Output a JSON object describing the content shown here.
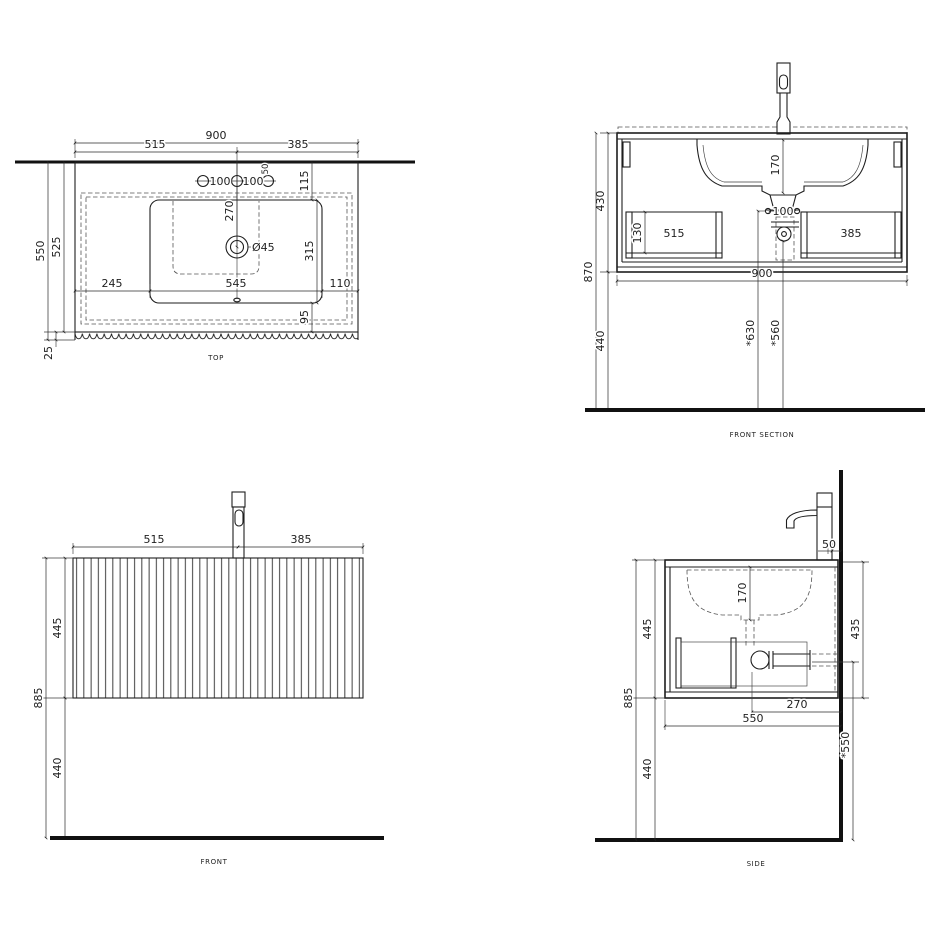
{
  "colors": {
    "ink": "#1e1e1e",
    "background": "#ffffff"
  },
  "views": {
    "top": {
      "title": "TOP",
      "dims": {
        "total_width": "900",
        "left_span": "515",
        "right_span": "385",
        "hole_gap_a": "100",
        "hole_gap_b": "100",
        "side_hole_dia": "50",
        "back_offset": "115",
        "wall_to_drain": "270",
        "cutout_depth": "315",
        "cutout_to_front": "95",
        "depth_total": "550",
        "depth_body": "525",
        "front_edge": "25",
        "left_margin": "245",
        "cutout_width": "545",
        "right_margin": "110",
        "drain_dia": "Ø45"
      }
    },
    "front_section": {
      "title": "FRONT SECTION",
      "dims": {
        "cabinet_height": "430",
        "total_height": "870",
        "floor_clearance": "440",
        "drawer_inner_height": "130",
        "left_drawer": "515",
        "right_drawer": "385",
        "basin_depth": "170",
        "screw_gap": "100",
        "total_width": "900",
        "outlet_height_a": "*630",
        "outlet_height_b": "*560"
      }
    },
    "front": {
      "title": "FRONT",
      "dims": {
        "left_span": "515",
        "right_span": "385",
        "cabinet_height": "445",
        "mount_height": "885",
        "floor_clearance": "440"
      }
    },
    "side": {
      "title": "SIDE",
      "dims": {
        "tap_wall_gap": "50",
        "basin_depth": "170",
        "cabinet_height": "445",
        "inner_height": "435",
        "mount_height": "885",
        "floor_clearance": "440",
        "drain_to_wall": "270",
        "depth_total": "550",
        "waste_height": "*550"
      }
    }
  }
}
